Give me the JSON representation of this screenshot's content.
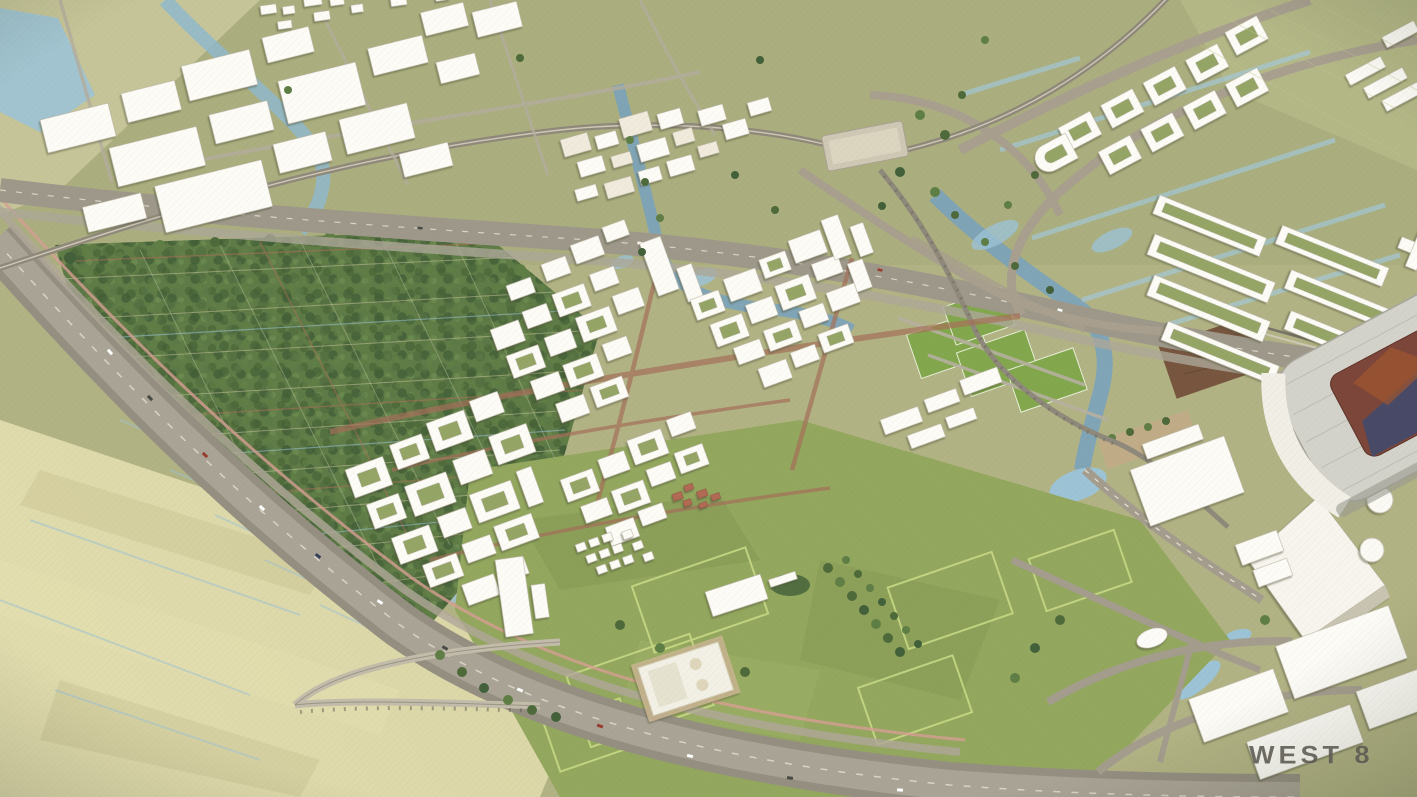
{
  "watermark": {
    "text": "WEST 8"
  },
  "palette": {
    "canvas": "#b2b384",
    "top_band": "#abae7e",
    "polder": "#d8d4a4",
    "park_green": "#5f7b46",
    "tree_dark": "#47623a",
    "grass": "#93a75e",
    "pitch": "#82a74c",
    "water": "#9cc3d6",
    "water_deep": "#7aa3bd",
    "road": "#a1998a",
    "road_light": "#bbb3a2",
    "building": "#fdfcf7",
    "building_shade": "#b7b09f",
    "path_red": "#b4715a",
    "dirt": "#77553e",
    "stadium_roof": "#d4d3cb",
    "stadium_red": "#7c463a",
    "stadium_blue": "#3e4a70",
    "watermark_color": "#5c5a50"
  }
}
